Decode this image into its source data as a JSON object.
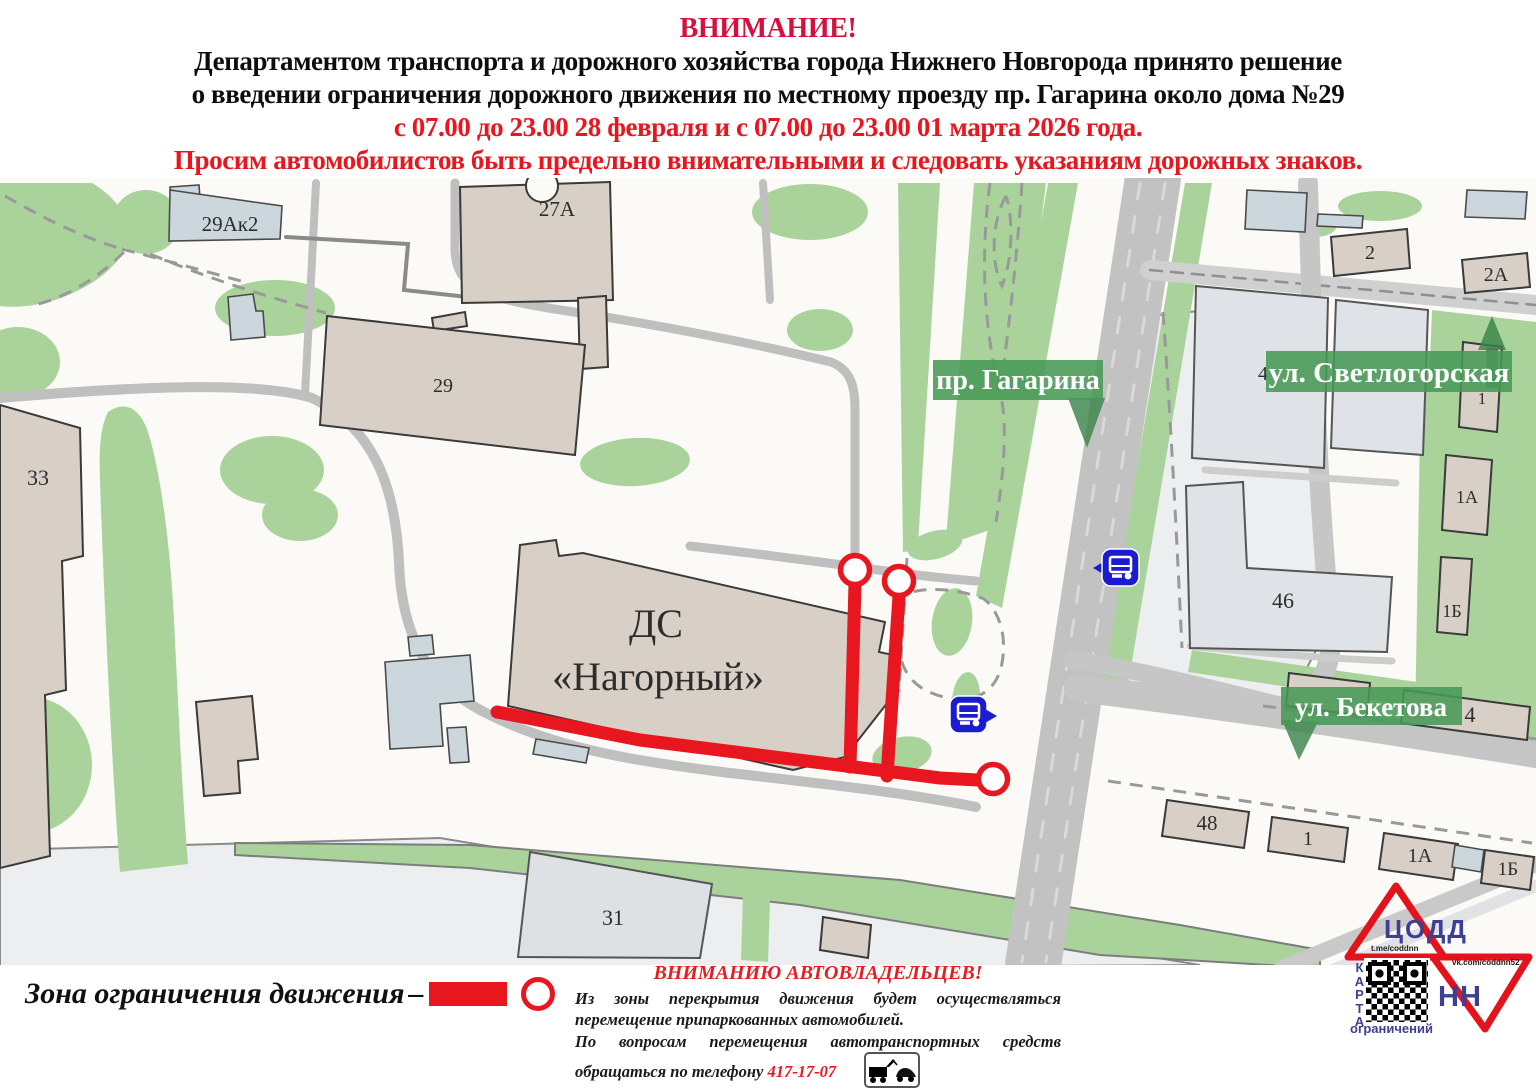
{
  "header": {
    "attention": "ВНИМАНИЕ!",
    "line1": "Департаментом транспорта и дорожного хозяйства города Нижнего Новгорода принято решение",
    "line2": "о введении ограничения дорожного движения по местному проезду пр. Гагарина около дома №29",
    "dates": "с 07.00 до 23.00 28 февраля и с 07.00 до 23.00 01 марта 2026 года.",
    "warning": "Просим автомобилистов быть предельно внимательными и следовать указаниям дорожных знаков."
  },
  "map": {
    "streets": {
      "gagarina": "пр. Гагарина",
      "svetlogorskaya": "ул. Светлогорская",
      "beketova": "ул. Бекетова"
    },
    "buildings": {
      "b29ak2": "29Ак2",
      "b27a": "27А",
      "b29": "29",
      "b33": "33",
      "ds1": "ДС",
      "ds2": "«Нагорный»",
      "b2": "2",
      "b2a": "2А",
      "b4svet": "4",
      "b1svet": "1",
      "b46": "46",
      "b1a": "1А",
      "b1b": "1Б",
      "b4bek": "4",
      "b48": "48",
      "b1bot": "1",
      "b1abot": "1А",
      "b1bbot": "1Б",
      "b31": "31"
    }
  },
  "legend": {
    "label": "Зона ограничения движения",
    "dash": "–"
  },
  "notice": {
    "title": "ВНИМАНИЮ АВТОВЛАДЕЛЬЦЕВ!",
    "p1": "Из зоны перекрытия движения будет осуществляться перемещение припаркованных автомобилей.",
    "p2": "По вопросам перемещения автотранспортных средств обращаться по телефону",
    "phone": "417-17-07"
  },
  "logo": {
    "org": "ЦОДД",
    "city": "НН",
    "telegram": "t.me/coddnn",
    "vk": "vk.com/coddnn52",
    "karta": "КАРТА",
    "restrictions": "ограничений"
  },
  "colors": {
    "attention_red": "#d60f3c",
    "alert_red": "#e8161e",
    "map_green": "#aad39c",
    "badge_green": "#489856",
    "road_gray": "#c2c2c2",
    "building_beige": "#d8cfc7",
    "building_gray": "#dfe3e7",
    "bus_icon_blue": "#1b1bd0",
    "logo_blue": "#3c3f94"
  }
}
